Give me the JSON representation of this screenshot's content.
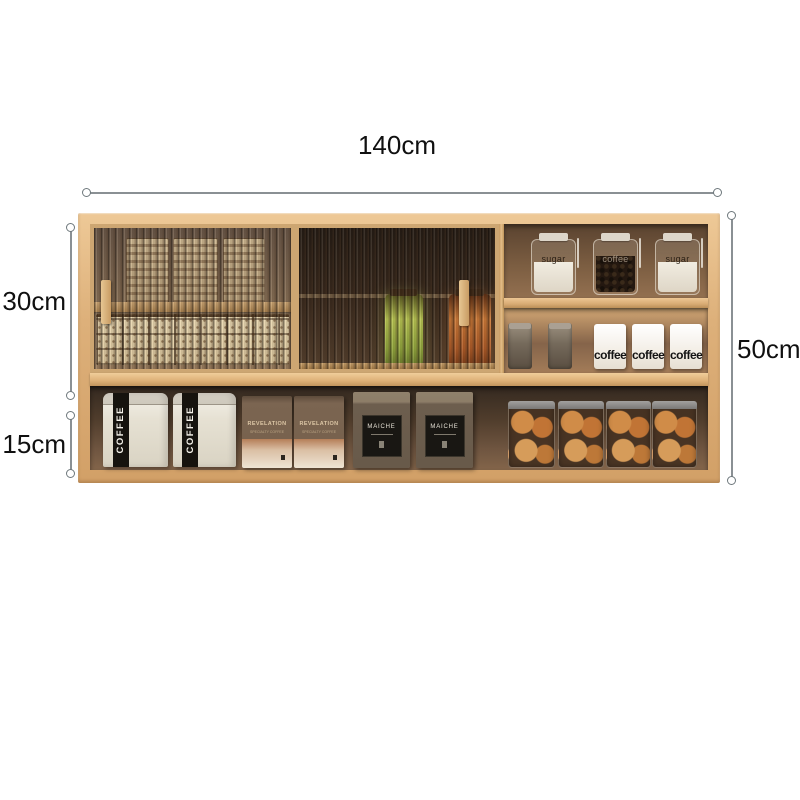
{
  "diagram": {
    "dimensions": {
      "width": {
        "label": "140cm"
      },
      "upper_section_height": {
        "label": "30cm"
      },
      "lower_section_height": {
        "label": "15cm"
      },
      "total_height": {
        "label": "50cm"
      }
    },
    "colors": {
      "background": "#ffffff",
      "wood": "#d9a873",
      "wood_light": "#eec997",
      "interior_dark": "#4a3a2c",
      "dimension_line": "#8a9094",
      "text": "#101010",
      "bag_stripe": "#16130e",
      "cookie": "#d08c48"
    },
    "cabinet": {
      "upper_right": {
        "top_shelf_jars": [
          {
            "label": "sugar"
          },
          {
            "label": "coffee"
          },
          {
            "label": "sugar"
          }
        ],
        "lower_shelf_mugs": [
          {
            "label": "coffee"
          },
          {
            "label": "coffee"
          },
          {
            "label": "coffee"
          }
        ]
      },
      "bottom_shelf": {
        "coffee_bags": [
          {
            "label": "COFFEE"
          },
          {
            "label": "COFFEE"
          }
        ],
        "kraft_boxes": [
          {
            "label": "REVELATION",
            "subtext": "SPECIALTY COFFEE"
          },
          {
            "label": "REVELATION",
            "subtext": "SPECIALTY COFFEE"
          }
        ],
        "dark_boxes": [
          {
            "label": "MAICHE"
          },
          {
            "label": "MAICHE"
          }
        ]
      }
    }
  }
}
